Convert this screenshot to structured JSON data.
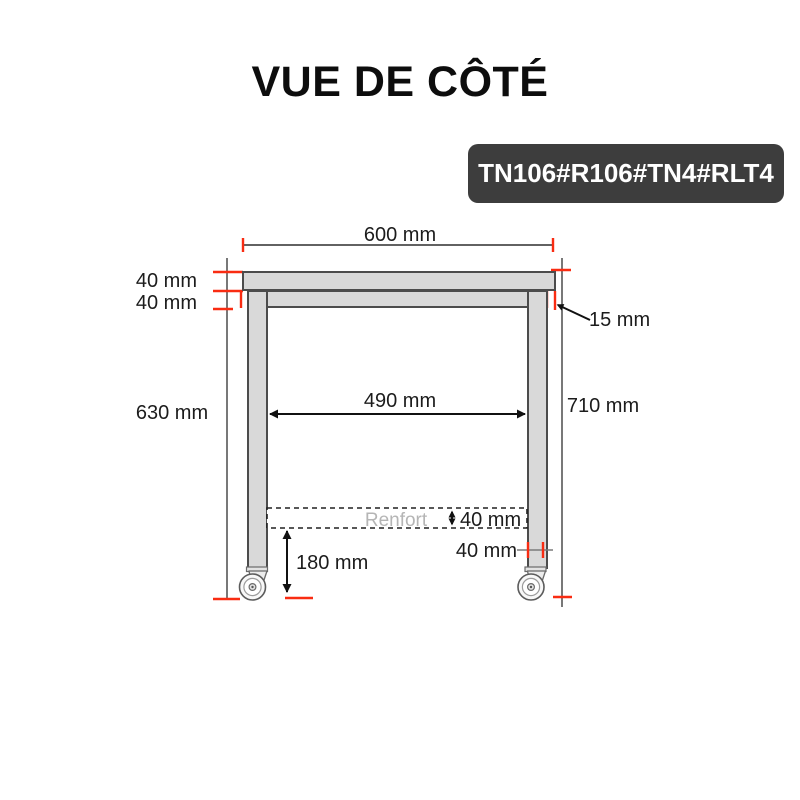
{
  "title": "VUE DE CÔTÉ",
  "badge": {
    "label": "TN106#R106#TN4#RLT4"
  },
  "diagram": {
    "type": "technical-side-view-drawing",
    "labels": {
      "top_width": "600 mm",
      "top_thickness": "40 mm",
      "frame_height": "40 mm",
      "overhang": "15 mm",
      "leg_height": "630 mm",
      "inner_width": "490 mm",
      "total_height": "710 mm",
      "renfort": "Renfort",
      "renfort_height": "40 mm",
      "leg_width": "40 mm",
      "caster_height": "180 mm"
    }
  },
  "colors": {
    "red": "#f92c12",
    "badge-bg": "#3d3d3d",
    "badge-text": "#ffffff",
    "shape-fill": "#d9d9d9",
    "shape-stroke": "#4c4c4c",
    "renfort-gray": "#b5b5b5",
    "text-dark": "#1c1c1c",
    "ext-gray": "#3e3e3e"
  }
}
